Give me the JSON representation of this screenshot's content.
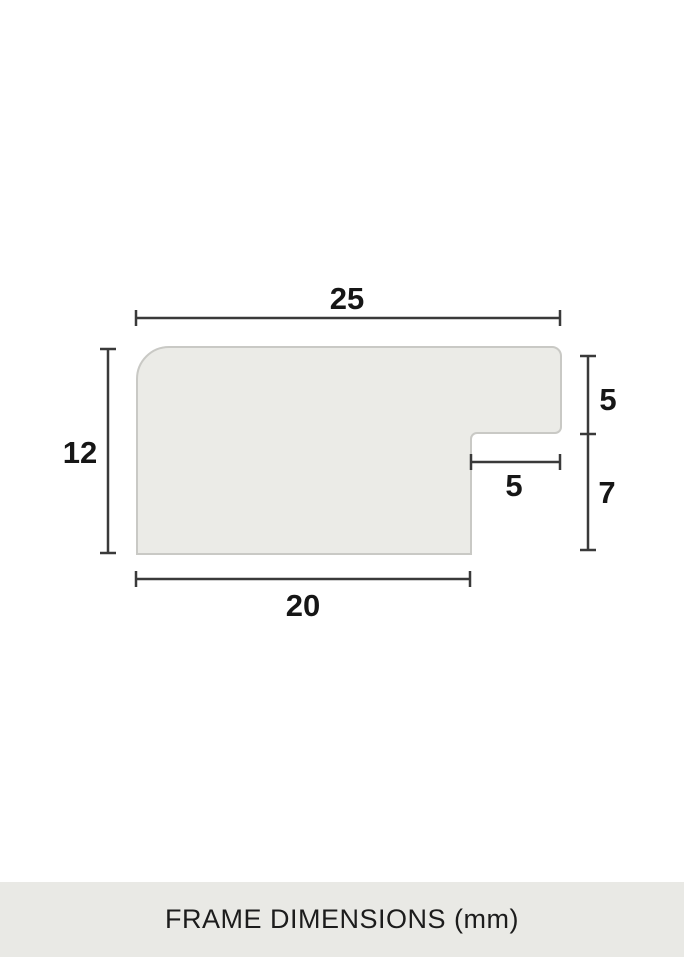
{
  "diagram": {
    "title": "FRAME DIMENSIONS (mm)",
    "unit": "mm",
    "dimensions": {
      "top_width": "25",
      "left_height": "12",
      "right_upper_depth": "5",
      "right_lower_depth": "7",
      "rabbet_width": "5",
      "bottom_width": "20"
    },
    "colors": {
      "background": "#ffffff",
      "profile_fill": "#ebebe7",
      "profile_stroke": "#c9c9c5",
      "dimension_line": "#3a3a3a",
      "label_text": "#161616",
      "caption_bg": "#e9e9e5",
      "caption_text": "#1c1c1c"
    }
  }
}
